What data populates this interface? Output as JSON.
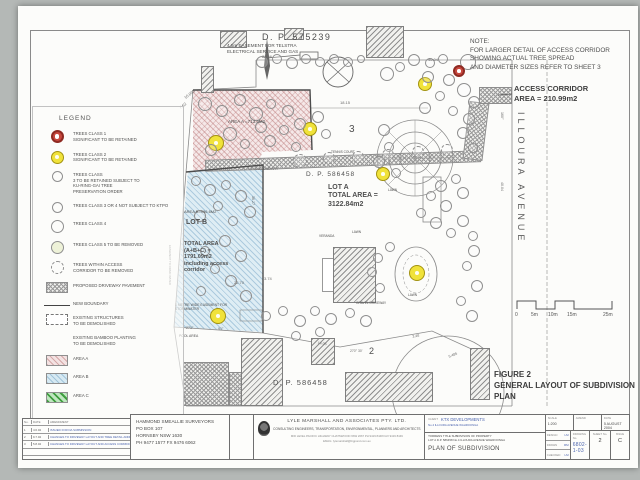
{
  "colors": {
    "area_a_pink": "#f3e2e2",
    "area_b_blue": "#d6e9f2",
    "area_c_green": "#bfe6bf",
    "tree_class1_red": "#c8483e",
    "tree_class2_yellow": "#f0e23a",
    "handwriting_blue": "#4a63ae",
    "ink": "#4f4f4f"
  },
  "note": {
    "text": "NOTE:\nFOR LARGER DETAIL OF ACCESS CORRIDOR\nSHOWING ACTUAL TREE SPREAD\nAND DIAMETER SIZES REFER TO SHEET 3"
  },
  "access_corridor": {
    "label": "ACCESS CORRIDOR\nAREA = 210.99m2"
  },
  "street": {
    "name": "ILLOURA   AVENUE"
  },
  "figure": {
    "caption": "FIGURE 2\nGENERAL LAYOUT OF SUBDIVISION\nPLAN"
  },
  "legend": {
    "title": "LEGEND",
    "items": [
      {
        "c": "t1",
        "t": "TREES CLASS 1\nSIGNIFICANT TO BE RETAINED"
      },
      {
        "c": "t2",
        "t": "TREES CLASS 2\nSIGNIFICANT TO BE RETAINED"
      },
      {
        "c": "t3",
        "t": "TREES CLASS\n3 TO BE RETAINED SUBJECT TO\nKU-RING-GAI TREE\nPRESERVATION ORDER"
      },
      {
        "c": "t3",
        "t": "TREES CLASS 3 OR 4 NOT SUBJECT TO KTPO"
      },
      {
        "c": "t4",
        "t": "TREES CLASS 4"
      },
      {
        "c": "t5",
        "t": "TREES CLASS 5 TO BE REMOVED"
      },
      {
        "c": "tx",
        "t": "TREES WITHIN ACCESS\nCORRIDOR TO BE REMOVED"
      },
      {
        "c": "drive",
        "t": "PROPOSED DRIVEWAY PAVEMENT"
      },
      {
        "c": "line",
        "t": "NEW BOUNDARY"
      },
      {
        "c": "dash",
        "t": "EXISTING STRUCTURES\nTO BE DEMOLISHED"
      },
      {
        "c": "bamboo",
        "t": "EXISTING BAMBOO PLANTING\nTO BE DEMOLISHED"
      },
      {
        "c": "areaA",
        "t": "AREA A"
      },
      {
        "c": "areaB",
        "t": "AREA B"
      },
      {
        "c": "areaC",
        "t": "AREA C"
      }
    ]
  },
  "labels": [
    {
      "t": "D. P. 575239",
      "x": 262,
      "y": 32,
      "fs": 9,
      "ls": 1.5
    },
    {
      "t": "4.5m EASEMENT FOR TELSTRA\nELECTRICAL SERVICE AND GAS",
      "x": 227,
      "y": 43,
      "fs": 4.6
    },
    {
      "t": "3",
      "x": 349,
      "y": 124,
      "fs": 10
    },
    {
      "t": "2",
      "x": 369,
      "y": 346,
      "fs": 9
    },
    {
      "t": "AREA A =713.4M2",
      "x": 228,
      "y": 119,
      "fs": 4.5
    },
    {
      "t": "D. P. 586458",
      "x": 306,
      "y": 171,
      "fs": 6.5,
      "ls": 1
    },
    {
      "t": "LOT A\nTOTAL AREA =\n3122.84m2",
      "x": 328,
      "y": 184,
      "fs": 7,
      "b": 1
    },
    {
      "t": "AREA B=996.6M2",
      "x": 184,
      "y": 210,
      "fs": 4
    },
    {
      "t": "LOT B",
      "x": 186,
      "y": 219,
      "fs": 7,
      "b": 1
    },
    {
      "t": "TOTAL AREA\n(A+B+C) =\n1791.09m2\nincluding access\ncorridor",
      "x": 184,
      "y": 241,
      "fs": 5.5,
      "b": 1
    },
    {
      "t": "D. P. 586458",
      "x": 273,
      "y": 378,
      "fs": 7.5,
      "ls": 1
    },
    {
      "t": "LAWN",
      "x": 388,
      "y": 189,
      "fs": 3.2
    },
    {
      "t": "LAWN",
      "x": 352,
      "y": 231,
      "fs": 3.2
    },
    {
      "t": "LAWN",
      "x": 408,
      "y": 294,
      "fs": 3.2
    },
    {
      "t": "GRAVEL DRIVEWAY",
      "x": 356,
      "y": 302,
      "fs": 3.2
    },
    {
      "t": "POOL AREA",
      "x": 179,
      "y": 334,
      "fs": 3.4
    },
    {
      "t": "VERANDA",
      "x": 319,
      "y": 235,
      "fs": 3.2
    },
    {
      "t": "TENNIS  COURT",
      "x": 331,
      "y": 151,
      "fs": 3.2
    },
    {
      "t": "1 METRE WIDE EASEMENT FOR\nSTORMWATER",
      "x": 175,
      "y": 303,
      "fs": 3.4
    }
  ],
  "dims": [
    {
      "t": "28.06",
      "x": 262,
      "y": 54,
      "fs": 4
    },
    {
      "t": "40.04",
      "x": 428,
      "y": 57,
      "fs": 4
    },
    {
      "t": "18.15",
      "x": 340,
      "y": 100,
      "fs": 4
    },
    {
      "t": "10.095",
      "x": 183,
      "y": 96,
      "fs": 4,
      "rot": -38
    },
    {
      "t": "7.62",
      "x": 178,
      "y": 106,
      "fs": 4,
      "rot": -38
    },
    {
      "t": "13.99 BOUNDARY",
      "x": 248,
      "y": 167,
      "fs": 3.6
    },
    {
      "t": "36.27",
      "x": 255,
      "y": 196,
      "fs": 3.6,
      "rot": 90
    },
    {
      "t": "22.70",
      "x": 234,
      "y": 280,
      "fs": 4
    },
    {
      "t": "3.74",
      "x": 264,
      "y": 276,
      "fs": 4
    },
    {
      "t": "271°",
      "x": 186,
      "y": 326,
      "fs": 3.6
    },
    {
      "t": "91°",
      "x": 218,
      "y": 327,
      "fs": 3.6
    },
    {
      "t": "14.06",
      "x": 318,
      "y": 341,
      "fs": 3.6,
      "rot": 8
    },
    {
      "t": "3.48",
      "x": 412,
      "y": 335,
      "fs": 3.6,
      "rot": -12
    },
    {
      "t": "5.485",
      "x": 448,
      "y": 355,
      "fs": 3.6,
      "rot": -22
    },
    {
      "t": "270° 30'",
      "x": 350,
      "y": 349,
      "fs": 3.4
    },
    {
      "t": "160°",
      "x": 504,
      "y": 112,
      "fs": 3.6,
      "rot": 90
    },
    {
      "t": "40.04",
      "x": 504,
      "y": 182,
      "fs": 3.6,
      "rot": 90
    },
    {
      "t": "EASEMENT TO DRAIN WATER",
      "x": 172,
      "y": 245,
      "fs": 2.8,
      "rot": 90
    }
  ],
  "trees": [
    {
      "x": 262,
      "y": 62,
      "r": 6
    },
    {
      "x": 277,
      "y": 59,
      "r": 5
    },
    {
      "x": 292,
      "y": 63,
      "r": 6
    },
    {
      "x": 306,
      "y": 59,
      "r": 5
    },
    {
      "x": 320,
      "y": 62,
      "r": 5
    },
    {
      "x": 334,
      "y": 59,
      "r": 5
    },
    {
      "x": 348,
      "y": 62,
      "r": 5
    },
    {
      "x": 361,
      "y": 59,
      "r": 4
    },
    {
      "x": 414,
      "y": 60,
      "r": 6
    },
    {
      "x": 430,
      "y": 63,
      "r": 5
    },
    {
      "x": 443,
      "y": 59,
      "r": 5
    },
    {
      "x": 468,
      "y": 62,
      "r": 8
    },
    {
      "x": 459,
      "y": 71,
      "r": 6,
      "c": "1"
    },
    {
      "x": 216,
      "y": 143,
      "r": 8,
      "c": "2"
    },
    {
      "x": 310,
      "y": 129,
      "r": 7,
      "c": "2"
    },
    {
      "x": 425,
      "y": 84,
      "r": 7,
      "c": "2"
    },
    {
      "x": 383,
      "y": 174,
      "r": 7,
      "c": "2"
    },
    {
      "x": 417,
      "y": 273,
      "r": 8,
      "c": "2"
    },
    {
      "x": 218,
      "y": 316,
      "r": 8,
      "c": "2"
    },
    {
      "x": 387,
      "y": 74,
      "r": 7
    },
    {
      "x": 400,
      "y": 67,
      "r": 5
    },
    {
      "x": 428,
      "y": 77,
      "r": 6
    },
    {
      "x": 449,
      "y": 80,
      "r": 6
    },
    {
      "x": 464,
      "y": 90,
      "r": 7
    },
    {
      "x": 474,
      "y": 102,
      "r": 6
    },
    {
      "x": 440,
      "y": 96,
      "r": 5
    },
    {
      "x": 425,
      "y": 108,
      "r": 6
    },
    {
      "x": 453,
      "y": 111,
      "r": 5
    },
    {
      "x": 469,
      "y": 119,
      "r": 6
    },
    {
      "x": 463,
      "y": 133,
      "r": 6
    },
    {
      "x": 473,
      "y": 148,
      "r": 5
    },
    {
      "x": 384,
      "y": 130,
      "r": 6
    },
    {
      "x": 389,
      "y": 147,
      "r": 5
    },
    {
      "x": 379,
      "y": 162,
      "r": 6
    },
    {
      "x": 396,
      "y": 173,
      "r": 5
    },
    {
      "x": 441,
      "y": 186,
      "r": 6
    },
    {
      "x": 456,
      "y": 179,
      "r": 5
    },
    {
      "x": 463,
      "y": 193,
      "r": 6
    },
    {
      "x": 431,
      "y": 196,
      "r": 5
    },
    {
      "x": 446,
      "y": 206,
      "r": 6
    },
    {
      "x": 421,
      "y": 213,
      "r": 5
    },
    {
      "x": 436,
      "y": 223,
      "r": 6
    },
    {
      "x": 451,
      "y": 233,
      "r": 5
    },
    {
      "x": 463,
      "y": 221,
      "r": 6
    },
    {
      "x": 473,
      "y": 236,
      "r": 5
    },
    {
      "x": 205,
      "y": 104,
      "r": 7
    },
    {
      "x": 222,
      "y": 111,
      "r": 6
    },
    {
      "x": 240,
      "y": 100,
      "r": 6
    },
    {
      "x": 256,
      "y": 114,
      "r": 7
    },
    {
      "x": 271,
      "y": 104,
      "r": 5
    },
    {
      "x": 288,
      "y": 111,
      "r": 6
    },
    {
      "x": 300,
      "y": 124,
      "r": 6
    },
    {
      "x": 284,
      "y": 130,
      "r": 5
    },
    {
      "x": 261,
      "y": 127,
      "r": 6
    },
    {
      "x": 230,
      "y": 134,
      "r": 7
    },
    {
      "x": 211,
      "y": 150,
      "r": 6
    },
    {
      "x": 245,
      "y": 144,
      "r": 5
    },
    {
      "x": 270,
      "y": 141,
      "r": 6
    },
    {
      "x": 296,
      "y": 147,
      "r": 5
    },
    {
      "x": 318,
      "y": 117,
      "r": 6
    },
    {
      "x": 326,
      "y": 134,
      "r": 5
    },
    {
      "x": 196,
      "y": 181,
      "r": 5
    },
    {
      "x": 210,
      "y": 190,
      "r": 6
    },
    {
      "x": 226,
      "y": 185,
      "r": 5
    },
    {
      "x": 241,
      "y": 196,
      "r": 6
    },
    {
      "x": 218,
      "y": 206,
      "r": 5
    },
    {
      "x": 200,
      "y": 216,
      "r": 6
    },
    {
      "x": 233,
      "y": 221,
      "r": 5
    },
    {
      "x": 250,
      "y": 212,
      "r": 6
    },
    {
      "x": 225,
      "y": 241,
      "r": 6
    },
    {
      "x": 205,
      "y": 251,
      "r": 5
    },
    {
      "x": 241,
      "y": 256,
      "r": 6
    },
    {
      "x": 215,
      "y": 269,
      "r": 5
    },
    {
      "x": 231,
      "y": 281,
      "r": 6
    },
    {
      "x": 201,
      "y": 291,
      "r": 5
    },
    {
      "x": 246,
      "y": 296,
      "r": 6
    },
    {
      "x": 474,
      "y": 251,
      "r": 6
    },
    {
      "x": 467,
      "y": 266,
      "r": 5
    },
    {
      "x": 477,
      "y": 286,
      "r": 6
    },
    {
      "x": 461,
      "y": 301,
      "r": 5
    },
    {
      "x": 472,
      "y": 316,
      "r": 6
    },
    {
      "x": 300,
      "y": 321,
      "r": 6
    },
    {
      "x": 315,
      "y": 311,
      "r": 5
    },
    {
      "x": 331,
      "y": 319,
      "r": 6
    },
    {
      "x": 350,
      "y": 313,
      "r": 5
    },
    {
      "x": 366,
      "y": 321,
      "r": 6
    },
    {
      "x": 283,
      "y": 311,
      "r": 5
    },
    {
      "x": 266,
      "y": 316,
      "r": 5
    },
    {
      "x": 390,
      "y": 247,
      "r": 5
    },
    {
      "x": 378,
      "y": 258,
      "r": 5
    },
    {
      "x": 372,
      "y": 272,
      "r": 5
    },
    {
      "x": 380,
      "y": 288,
      "r": 5
    },
    {
      "x": 296,
      "y": 336,
      "r": 5
    },
    {
      "x": 320,
      "y": 332,
      "r": 5
    },
    {
      "x": 300,
      "y": 161,
      "r": 7,
      "c": "x"
    },
    {
      "x": 329,
      "y": 158,
      "r": 6,
      "c": "x"
    },
    {
      "x": 358,
      "y": 157,
      "r": 6,
      "c": "x"
    },
    {
      "x": 388,
      "y": 155,
      "r": 6,
      "c": "x"
    },
    {
      "x": 418,
      "y": 152,
      "r": 6,
      "c": "x"
    },
    {
      "x": 447,
      "y": 150,
      "r": 6,
      "c": "x"
    }
  ],
  "buildings": [
    {
      "x": 220,
      "y": 31,
      "w": 27,
      "h": 17
    },
    {
      "x": 284,
      "y": 28,
      "w": 20,
      "h": 12
    },
    {
      "x": 366,
      "y": 26,
      "w": 38,
      "h": 32
    },
    {
      "x": 201,
      "y": 66,
      "w": 13,
      "h": 27
    },
    {
      "x": 241,
      "y": 338,
      "w": 42,
      "h": 68
    },
    {
      "x": 311,
      "y": 338,
      "w": 24,
      "h": 27
    },
    {
      "x": 345,
      "y": 372,
      "w": 88,
      "h": 30
    },
    {
      "x": 470,
      "y": 348,
      "w": 20,
      "h": 52
    },
    {
      "x": 333,
      "y": 247,
      "w": 43,
      "h": 56
    }
  ],
  "scale_bar": {
    "ticks": [
      {
        "t": "0",
        "x": 515
      },
      {
        "t": "5m",
        "x": 531
      },
      {
        "t": "10m",
        "x": 548
      },
      {
        "t": "15m",
        "x": 567
      },
      {
        "t": "25m",
        "x": 603
      }
    ]
  },
  "title_block": {
    "surveyor": "HAMMOND SMEALLIE SURVEYORS\nPO BOX 107\nHORNSBY NSW 1630\nPH 9477 1577 FX 9476 6062",
    "consultant": {
      "name": "LYLE MARSHALL AND ASSOCIATES  PTY.  LTD.",
      "line2": "CONSULTING ENGINEERS, TRANSPORTATION, ENVIRONMENTAL, PLANNERS AND ARCHITECTS",
      "line3": "MID LEVEL PACIFIC HIGHWAY CHATSWOOD NSW 2067 PH 9419 8448 FAX 9419 8449",
      "line4": "EMAIL: lylemarshall@bigpond.com.au"
    },
    "client": {
      "label": "CLIENT",
      "name": "KTX DEVELOPMENTS",
      "line2": "No.4 ILLOURA AVENUE WAHROONGA"
    },
    "project": {
      "line1": "TORRENS TITLE SUBDIVISION OF PROPERTY",
      "line2": "LOT A D.P. 586458 No.4 ILLOURA AVENUE WAHROONGA",
      "title": "PLAN OF SUBDIVISION"
    },
    "fields": {
      "scale_label": "SCALE",
      "scale": "1:200",
      "amend_label": "AMEND",
      "amend": "",
      "date_label": "DATE",
      "date": "5 AUGUST 2004",
      "design_label": "DESIGN",
      "design": "LM",
      "drawn_label": "DRAWN",
      "drawn": "RM",
      "checked_label": "CHECKED",
      "checked": "LM",
      "drawing_no_label": "DRAWING No.",
      "drawing_no": "6802-1-03",
      "sheet_label": "SHEET No.",
      "sheet": "2",
      "issue_label": "ISSUE",
      "issue": "C"
    }
  },
  "revisions": {
    "head": {
      "no": "No.",
      "date": "DATE",
      "desc": "AMENDMENT"
    },
    "rows": [
      {
        "no": "1",
        "date": "4.6.04",
        "desc": "ISSUED FOR DA SUBMISSION"
      },
      {
        "no": "2",
        "date": "9.7.04",
        "desc": "CHANGES TO DRIVEWAY LAYOUT AND TREE DETAIL ADDED"
      },
      {
        "no": "3",
        "date": "5.8.04",
        "desc": "CHANGES TO DRIVEWAY LAYOUT AND ACCESS CORRIDOR"
      },
      {
        "no": "",
        "date": "",
        "desc": ""
      },
      {
        "no": "",
        "date": "",
        "desc": ""
      }
    ]
  }
}
